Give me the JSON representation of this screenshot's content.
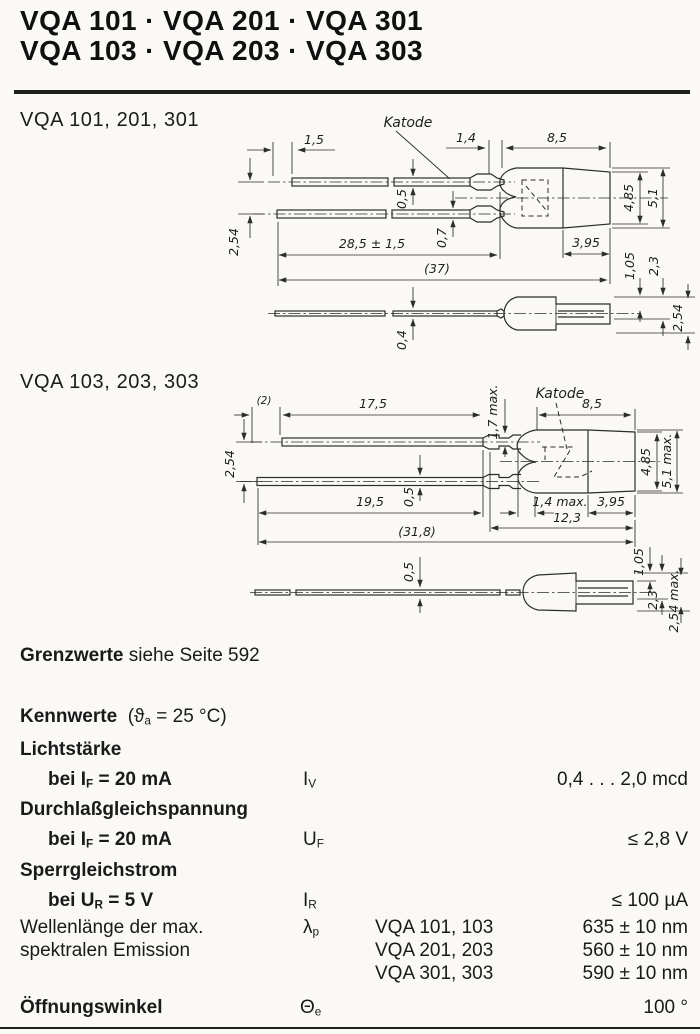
{
  "title": {
    "line1": "VQA 101 · VQA 201 · VQA 301",
    "line2": "VQA 103 · VQA 203 · VQA 303"
  },
  "drawing1": {
    "label": "VQA 101, 201, 301",
    "katode": "Katode",
    "dims": {
      "d1": "1,5",
      "d2": "1,4",
      "d3": "8,5",
      "d4": "0,5",
      "d5": "0,7",
      "d6": "2,54",
      "d7": "28,5 ± 1,5",
      "d8": "(37)",
      "d9": "3,95",
      "d10": "4,85",
      "d11": "5,1",
      "d12": "1,05",
      "d13": "2,3",
      "d14": "2,54",
      "d15": "0,4"
    }
  },
  "drawing2": {
    "label": "VQA 103, 203, 303",
    "katode": "Katode",
    "dims": {
      "d1": "(2)",
      "d2": "17,5",
      "d3": "1,7 max.",
      "d4": "8,5",
      "d5": "2,54",
      "d6": "0,5",
      "d7": "19,5",
      "d8": "1,4 max.",
      "d9": "3,95",
      "d10": "12,3",
      "d11": "(31,8)",
      "d12": "4,85",
      "d13": "5,1 max.",
      "d14": "0,5",
      "d15": "1,05",
      "d16": "2,3",
      "d17": "2,54 max."
    }
  },
  "grenzwerte": {
    "bold": "Grenzwerte",
    "rest": " siehe Seite 592"
  },
  "kennwerte": {
    "heading_bold": "Kennwerte",
    "cond_pre": "  (ϑ",
    "cond_sub": "a",
    "cond_post": " = 25 °C)",
    "rows": {
      "r1": {
        "label": "Lichtstärke"
      },
      "r2": {
        "l1": "bei I",
        "l1s": "F",
        "l2": " = 20 mA",
        "sym": "I",
        "syms": "V",
        "val": "0,4 . . . 2,0 mcd"
      },
      "r3": {
        "label": "Durchlaßgleichspannung"
      },
      "r4": {
        "l1": "bei I",
        "l1s": "F",
        "l2": " = 20 mA",
        "sym": "U",
        "syms": "F",
        "val": "≤ 2,8 V"
      },
      "r5": {
        "label": "Sperrgleichstrom"
      },
      "r6": {
        "l1": "bei U",
        "l1s": "R",
        "l2": " = 5 V",
        "sym": "I",
        "syms": "R",
        "val": "≤ 100 µA"
      },
      "r7": {
        "l1": "Wellenlänge der max.",
        "l2": "spektralen Emission",
        "sym": "λ",
        "syms": "p",
        "t1": "VQA 101, 103",
        "t2": "VQA 201, 203",
        "t3": "VQA 301, 303",
        "v1": "635 ± 10 nm",
        "v2": "560 ± 10 nm",
        "v3": "590 ± 10 nm"
      },
      "r8": {
        "label": "Öffnungswinkel",
        "sym": "Θ",
        "syms": "e",
        "val": "100 °"
      }
    }
  }
}
